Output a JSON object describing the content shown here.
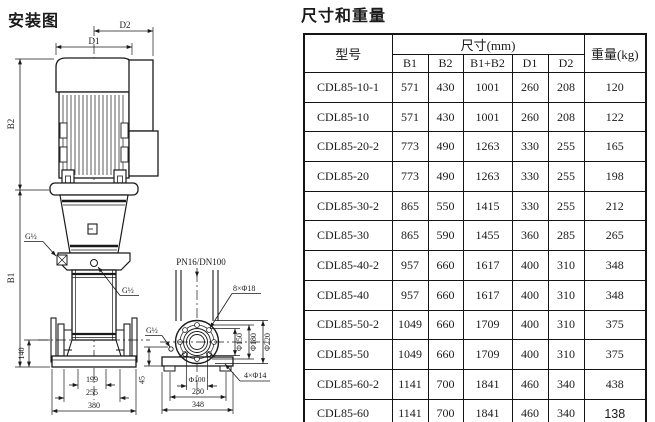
{
  "installation": {
    "title": "安装图",
    "labels": {
      "d1": "D1",
      "d2": "D2",
      "b1": "B1",
      "b2": "B2",
      "g_half": "G½",
      "pn": "PN16/DN100",
      "flange_holes": "8×Φ18",
      "phi150": "Φ150",
      "phi180": "Φ180",
      "phi220": "Φ220",
      "base_holes": "4×Φ14",
      "phi100": "Φ100",
      "dim_140": "140",
      "dim_199": "199",
      "dim_255": "255",
      "dim_380": "380",
      "dim_45": "45",
      "dim_280": "280",
      "dim_348": "348"
    }
  },
  "table_section": {
    "title": "尺寸和重量",
    "table": {
      "headers": {
        "model": "型号",
        "dims_group": "尺寸(mm)",
        "weight": "重量(kg)",
        "dim_cols": [
          "B1",
          "B2",
          "B1+B2",
          "D1",
          "D2"
        ]
      },
      "rows": [
        {
          "model": "CDL85-10-1",
          "b1": "571",
          "b2": "430",
          "b1b2": "1001",
          "d1": "260",
          "d2": "208",
          "weight": "120"
        },
        {
          "model": "CDL85-10",
          "b1": "571",
          "b2": "430",
          "b1b2": "1001",
          "d1": "260",
          "d2": "208",
          "weight": "122"
        },
        {
          "model": "CDL85-20-2",
          "b1": "773",
          "b2": "490",
          "b1b2": "1263",
          "d1": "330",
          "d2": "255",
          "weight": "165"
        },
        {
          "model": "CDL85-20",
          "b1": "773",
          "b2": "490",
          "b1b2": "1263",
          "d1": "330",
          "d2": "255",
          "weight": "198"
        },
        {
          "model": "CDL85-30-2",
          "b1": "865",
          "b2": "550",
          "b1b2": "1415",
          "d1": "330",
          "d2": "255",
          "weight": "212"
        },
        {
          "model": "CDL85-30",
          "b1": "865",
          "b2": "590",
          "b1b2": "1455",
          "d1": "360",
          "d2": "285",
          "weight": "265"
        },
        {
          "model": "CDL85-40-2",
          "b1": "957",
          "b2": "660",
          "b1b2": "1617",
          "d1": "400",
          "d2": "310",
          "weight": "348"
        },
        {
          "model": "CDL85-40",
          "b1": "957",
          "b2": "660",
          "b1b2": "1617",
          "d1": "400",
          "d2": "310",
          "weight": "348"
        },
        {
          "model": "CDL85-50-2",
          "b1": "1049",
          "b2": "660",
          "b1b2": "1709",
          "d1": "400",
          "d2": "310",
          "weight": "375"
        },
        {
          "model": "CDL85-50",
          "b1": "1049",
          "b2": "660",
          "b1b2": "1709",
          "d1": "400",
          "d2": "310",
          "weight": "375"
        },
        {
          "model": "CDL85-60-2",
          "b1": "1141",
          "b2": "700",
          "b1b2": "1841",
          "d1": "460",
          "d2": "340",
          "weight": "438"
        },
        {
          "model": "CDL85-60",
          "b1": "1141",
          "b2": "700",
          "b1b2": "1841",
          "d1": "460",
          "d2": "340",
          "weight": "138"
        }
      ]
    }
  }
}
